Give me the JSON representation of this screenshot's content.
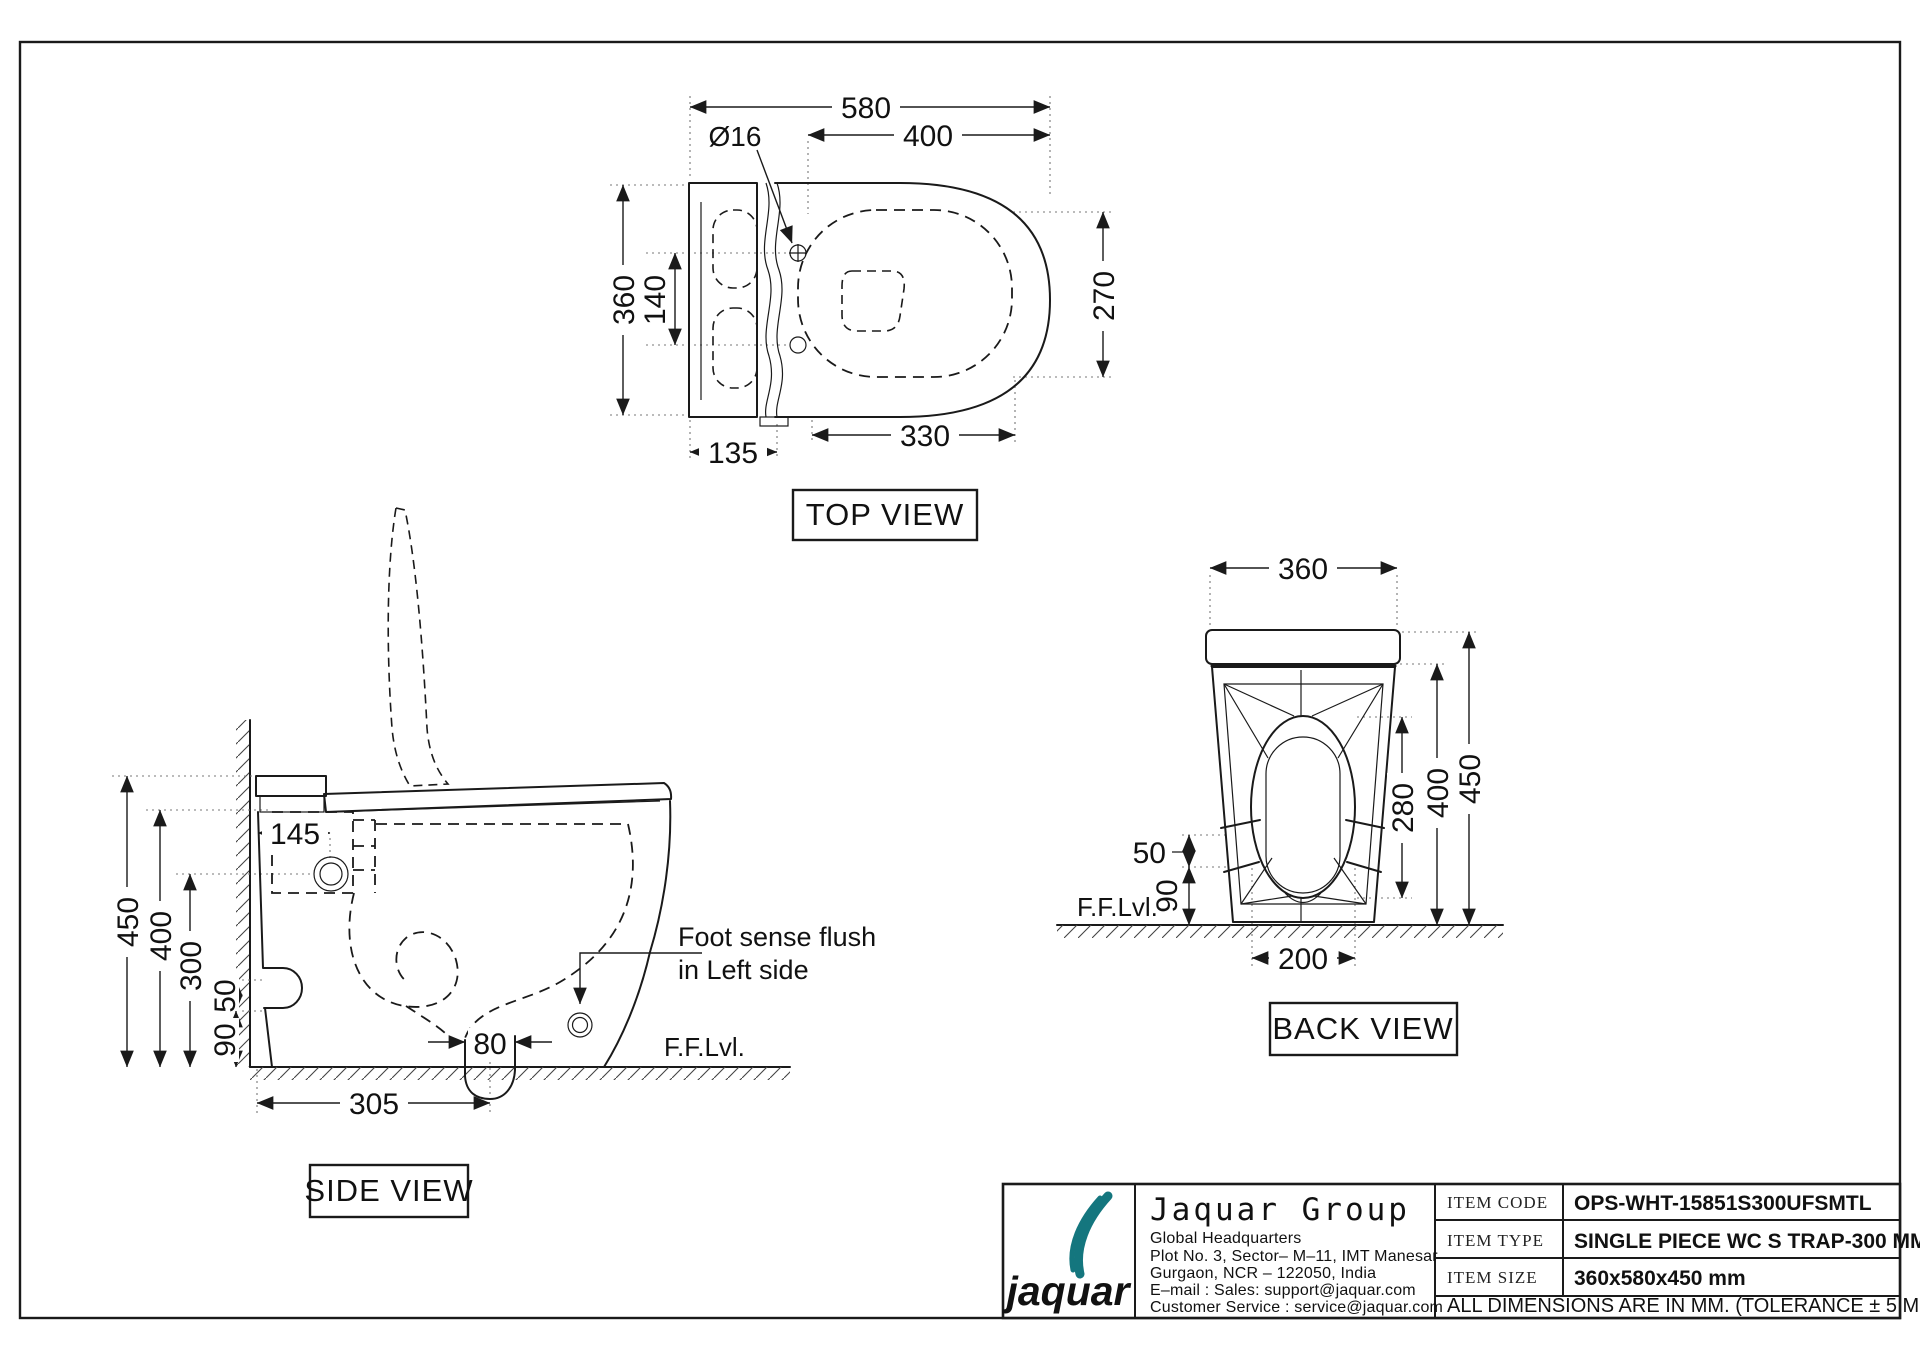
{
  "drawing": {
    "views": {
      "top": {
        "label": "TOP VIEW",
        "dim_580": "580",
        "dim_400": "400",
        "dim_dia": "Ø16",
        "dim_360": "360",
        "dim_140": "140",
        "dim_270": "270",
        "dim_330": "330",
        "dim_135": "135"
      },
      "side": {
        "label": "SIDE VIEW",
        "dim_450": "450",
        "dim_400": "400",
        "dim_300": "300",
        "dim_50": "50",
        "dim_90": "90",
        "dim_145": "145",
        "dim_80": "80",
        "dim_305": "305",
        "floor_level": "F.F.Lvl.",
        "note_line1": "Foot sense flush",
        "note_line2": "in Left side"
      },
      "back": {
        "label": "BACK VIEW",
        "dim_360": "360",
        "dim_450": "450",
        "dim_400": "400",
        "dim_280": "280",
        "dim_50": "50",
        "dim_90": "90",
        "dim_200": "200",
        "floor_level": "F.F.Lvl."
      }
    },
    "title_block": {
      "logo_text": "jaquar",
      "company": "Jaquar Group",
      "address_line1": "Global Headquarters",
      "address_line2": "Plot No. 3, Sector– M–11, IMT Manesar",
      "address_line3": "Gurgaon, NCR – 122050, India",
      "address_line4": "E–mail : Sales: support@jaquar.com",
      "address_line5": "Customer Service : service@jaquar.com",
      "item_code_label": "ITEM CODE",
      "item_code": "OPS-WHT-15851S300UFSMTL",
      "item_type_label": "ITEM TYPE",
      "item_type": "SINGLE PIECE WC S TRAP-300 MM",
      "item_size_label": "ITEM SIZE",
      "item_size": "360x580x450 mm",
      "note": "ALL DIMENSIONS ARE IN MM. (TOLERANCE ± 5 MM)"
    },
    "colors": {
      "line": "#1a1a1a",
      "brand_teal": "#14767e"
    }
  }
}
